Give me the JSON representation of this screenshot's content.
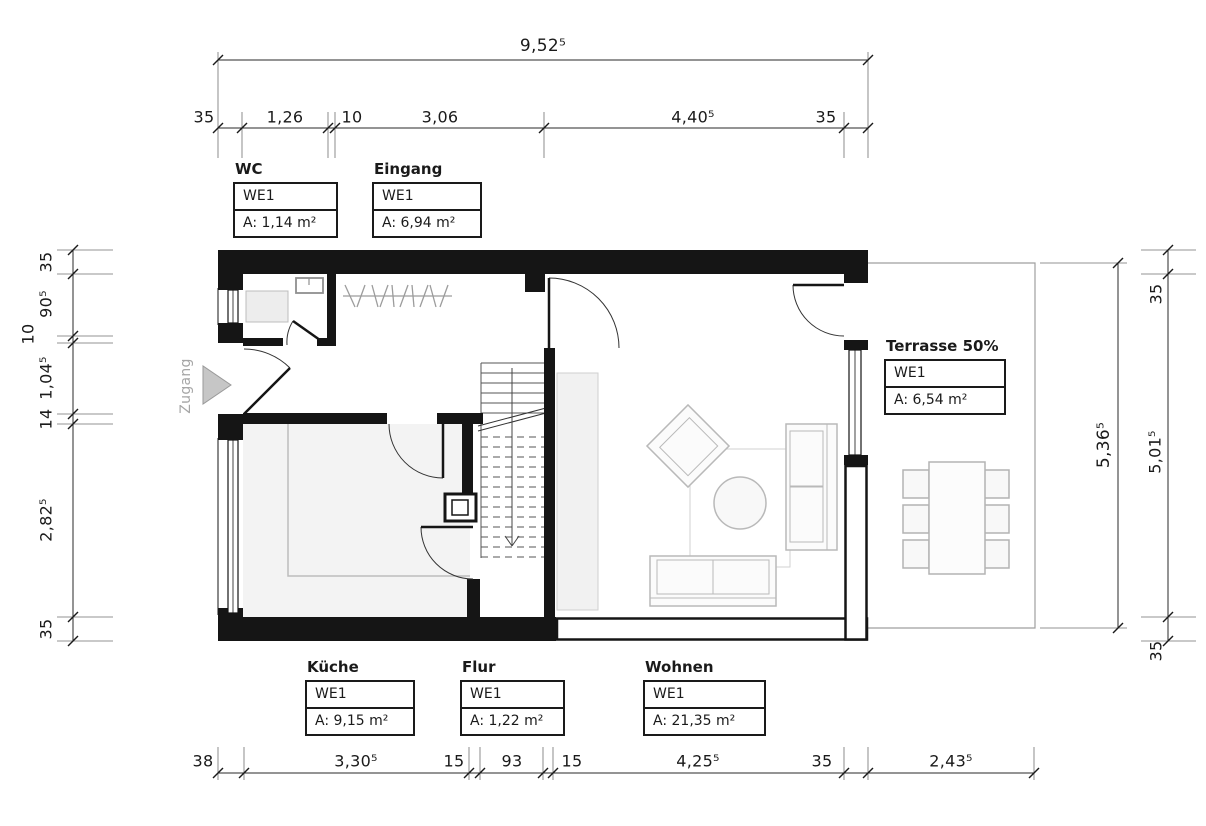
{
  "drawing": {
    "entrance_label": "Zugang",
    "dimensions": {
      "top_total": "9,52⁵",
      "top_chain": [
        "35",
        "1,26",
        "10",
        "3,06",
        "4,40⁵",
        "35"
      ],
      "left_chain": [
        "35",
        "90⁵",
        "10",
        "1,04⁵",
        "14",
        "2,82⁵",
        "35"
      ],
      "right_total": "5,36⁵",
      "right_chain": [
        "35",
        "5,01⁵",
        "35"
      ],
      "bottom_chain": [
        "38",
        "3,30⁵",
        "15",
        "93",
        "15",
        "4,25⁵",
        "35",
        "2,43⁵"
      ]
    },
    "rooms": [
      {
        "name": "WC",
        "unit": "WE1",
        "area": "A: 1,14 m²"
      },
      {
        "name": "Eingang",
        "unit": "WE1",
        "area": "A: 6,94 m²"
      },
      {
        "name": "Terrasse 50%",
        "unit": "WE1",
        "area": "A:  6,54 m²"
      },
      {
        "name": "Küche",
        "unit": "WE1",
        "area": "A: 9,15 m²"
      },
      {
        "name": "Flur",
        "unit": "WE1",
        "area": "A: 1,22 m²"
      },
      {
        "name": "Wohnen",
        "unit": "WE1",
        "area": "A: 21,35 m²"
      }
    ],
    "colors": {
      "line": "#1a1a1a",
      "wall": "#151515",
      "muted_gray": "#9a9a9a",
      "floor_gray": "#f3f3f3"
    }
  }
}
